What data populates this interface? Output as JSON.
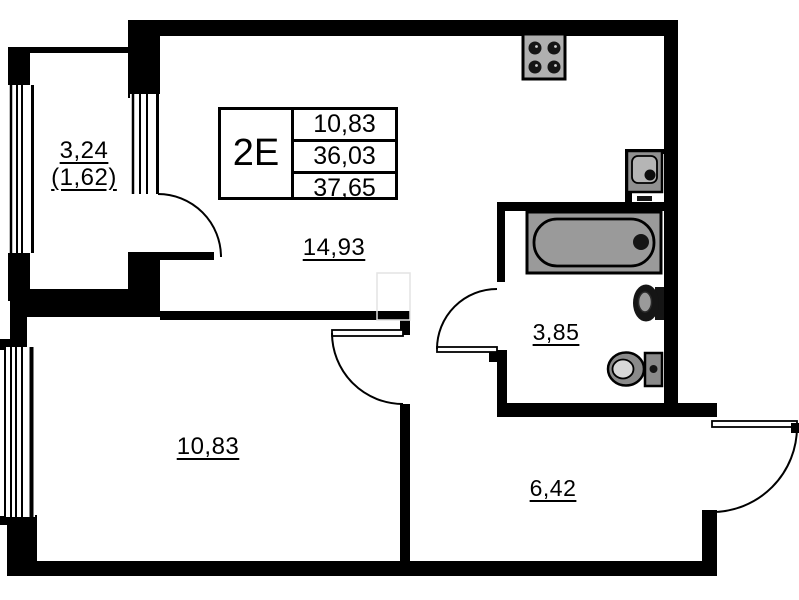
{
  "floor_plan": {
    "title_block": {
      "unit_type": "2E",
      "rows": [
        "10,83",
        "36,03",
        "37,65"
      ]
    },
    "room_labels": {
      "balcony_full": "3,24",
      "balcony_reduced": "(1,62)",
      "living_kitchen": "14,93",
      "bathroom": "3,85",
      "bedroom": "10,83",
      "hallway": "6,42"
    },
    "fixtures": {
      "stove": "stove-icon",
      "washing_machine": "washing-machine-icon",
      "bathtub": "bathtub-icon",
      "sink": "sink-icon",
      "toilet": "toilet-icon"
    },
    "colors": {
      "walls": "#000000",
      "fixture_fill": "#9a9a9a",
      "fixture_dark": "#151515",
      "background": "#ffffff"
    }
  }
}
